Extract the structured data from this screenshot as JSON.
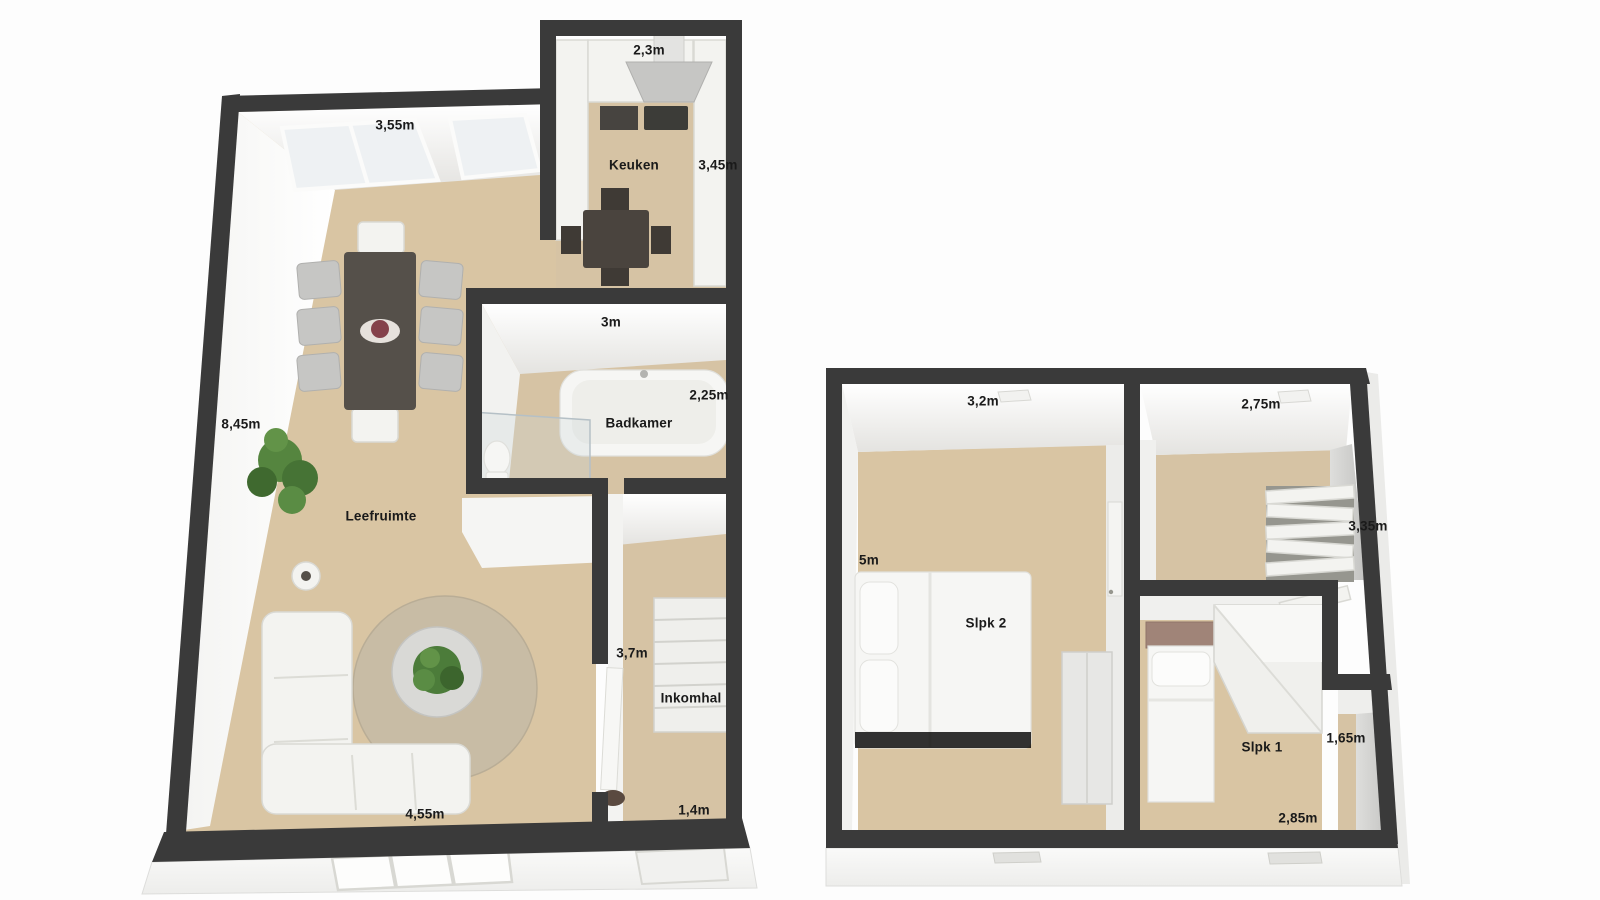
{
  "document": {
    "type": "3d-floor-plan",
    "floors": [
      "ground floor",
      "upper floor"
    ]
  },
  "colors": {
    "wall": "#3a3a3a",
    "floor": "#d9c5a3",
    "wall_face": "#f2f2ef",
    "label_text": "#1a1a1a",
    "background": "#fdfdfd"
  },
  "ground_floor": {
    "labels": {
      "living_top": "3,55m",
      "living_left": "8,45m",
      "living_bottom": "4,55m",
      "living_name": "Leefruimte",
      "kitchen_top": "2,3m",
      "kitchen_name": "Keuken",
      "kitchen_right": "3,45m",
      "bathroom_top": "3m",
      "bathroom_right": "2,25m",
      "bathroom_name": "Badkamer",
      "hall_left": "3,7m",
      "hall_name": "Inkomhal",
      "hall_bottom": "1,4m"
    }
  },
  "upper_floor": {
    "labels": {
      "bedroom2_top": "3,2m",
      "bedroom2_left": "5m",
      "bedroom2_name": "Slpk 2",
      "landing_top": "2,75m",
      "landing_right": "3,35m",
      "bedroom1_name": "Slpk 1",
      "bedroom1_right": "1,65m",
      "bedroom1_bottom": "2,85m"
    }
  }
}
